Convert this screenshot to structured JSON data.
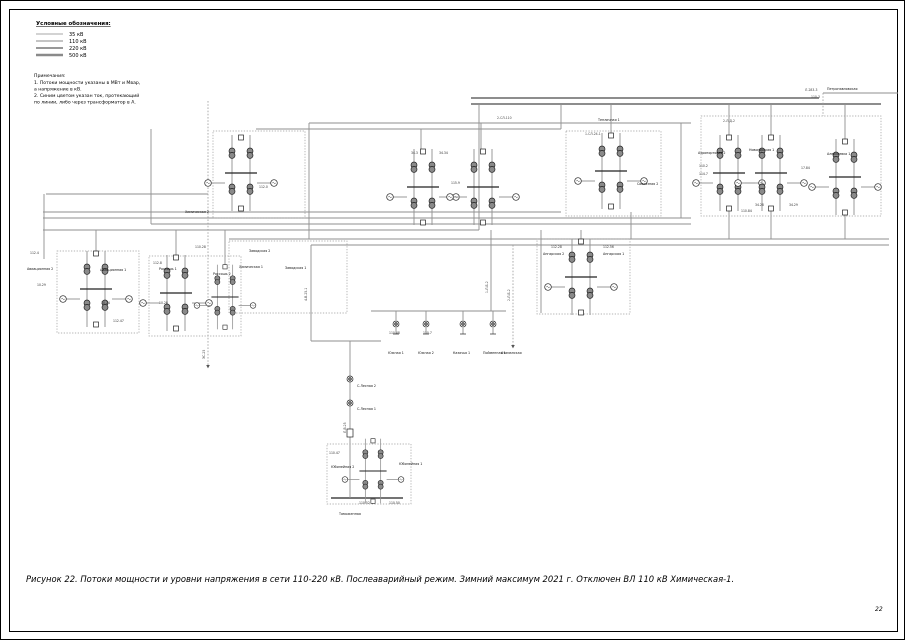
{
  "page": {
    "number": "22"
  },
  "legend": {
    "title": "Условные обозначения:",
    "items": [
      "35 кВ",
      "110 кВ",
      "220 кВ",
      "500 кВ"
    ]
  },
  "notes": {
    "lines": [
      "Примечания:",
      "1. Потоки мощности указаны в МВт и Мвар,",
      "а напряжение в кВ.",
      "2. Синим цветом указан ток, протекающий",
      "по линии, либо через трансформатор в А."
    ]
  },
  "caption": "Рисунок 22. Потоки мощности и уровни напряжения в сети 110-220 кВ. Послеаварийный режим. Зимний максимум  2021 г. Отключен ВЛ 110 кВ Химическая-1.",
  "colors": {
    "line_gray": "#8f8f8f",
    "line_220": "#7d7d7d",
    "symbol": "#222222"
  },
  "diagram": {
    "substations": [
      "Петропавловская",
      "Аэропортовая 2",
      "Новогорская 1",
      "Алексеевка 1",
      "Тепличная 1",
      "Совхозная 2",
      "Химическая 2",
      "Химическая 1",
      "Заводская 2",
      "Заводская 1",
      "Авиационная 2",
      "Авиационная 1",
      "Россошь 1",
      "Россошь 2",
      "Ангарская 2",
      "Ангарская 1",
      "Атаманская",
      "С.Лесная 2",
      "С.Лесная 1",
      "Юбилейная 2",
      "Юбилейная 1",
      "Таможенная",
      "Южная 1",
      "Южная 2",
      "Казачья 1",
      "Пойменная 1"
    ],
    "values": [
      "112.4",
      "10.29",
      "10.24",
      "112.47",
      "112.8",
      "110.28",
      "10.28",
      "112.28",
      "112.56",
      "34.3",
      "34.34",
      "110.48",
      "110.7",
      "115.9",
      "110.84",
      "110.2",
      "114.7",
      "17.84",
      "110.47",
      "110.52",
      "110.50",
      "112.0",
      "34.28",
      "34.29"
    ],
    "line_labels": [
      "Л-283-3",
      "110-3",
      "2-Л-Д-2",
      "1-СЛ-24-1",
      "2-СЛ-110",
      "ЭС-25",
      "4-В-25-1",
      "1-Л-Б-2",
      "2-Л-Б-2",
      "Л-В-25"
    ]
  }
}
